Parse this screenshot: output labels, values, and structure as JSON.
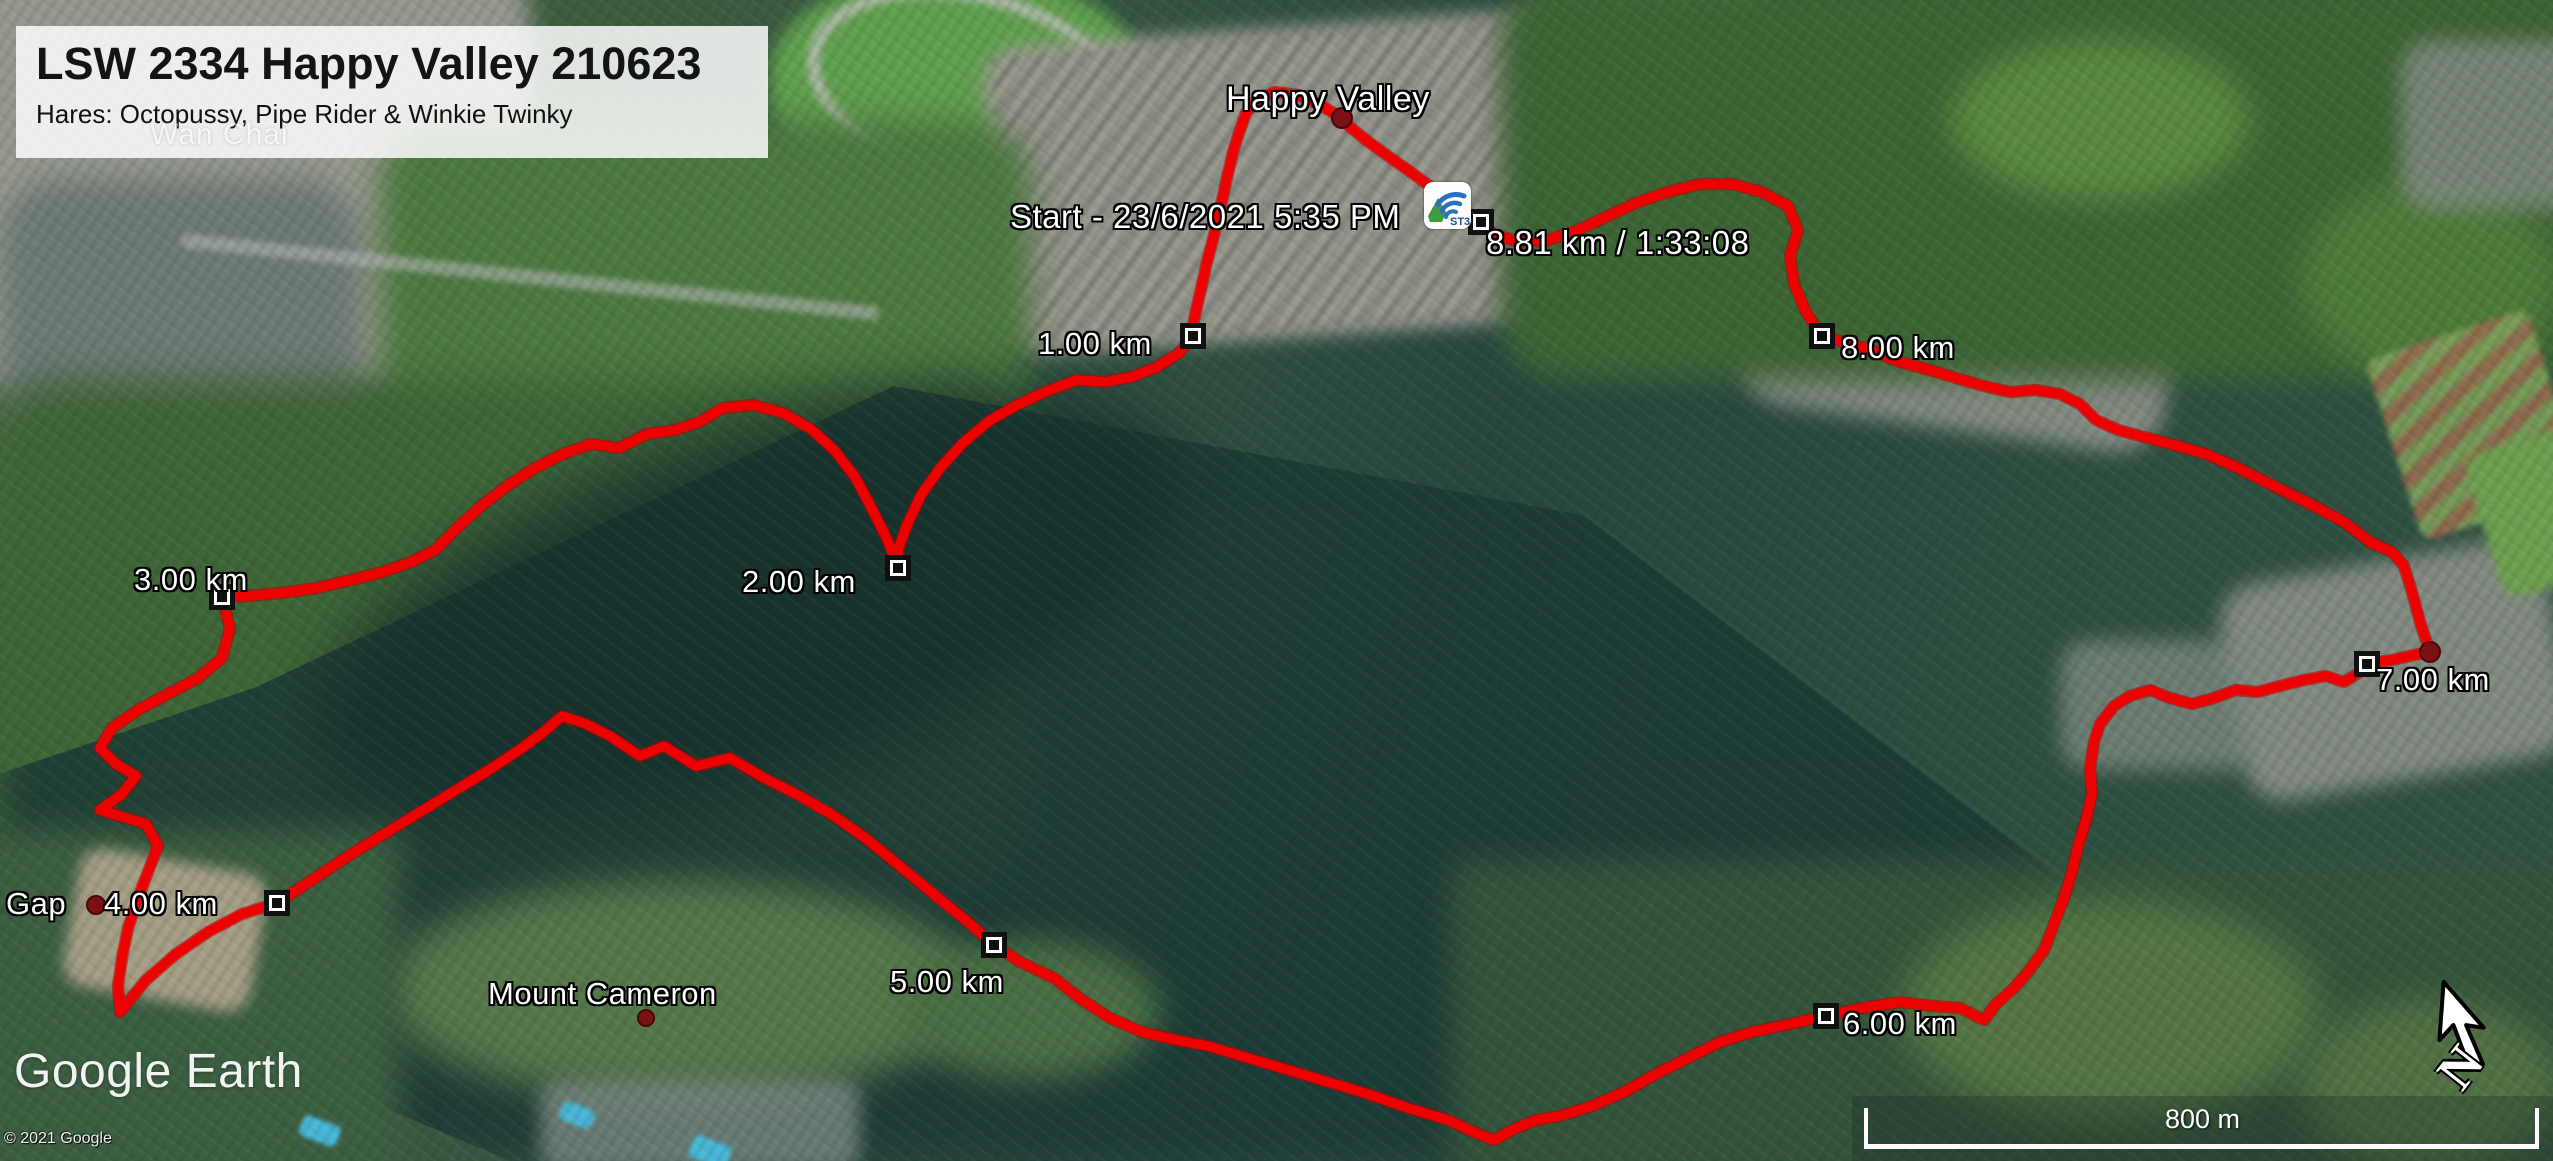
{
  "header": {
    "title": "LSW 2334 Happy Valley 210623",
    "subtitle": "Hares: Octopussy, Pipe Rider & Winkie Twinky"
  },
  "map_labels": {
    "background_place": "Wan Chai",
    "happy_valley": "Happy Valley",
    "start": "Start - 23/6/2021 5:35 PM",
    "gap": "Gap",
    "mount_cameron": "Mount Cameron"
  },
  "route": {
    "color": "#ee0201",
    "outline_color": "#b50000",
    "total_distance_km": "8.81 km",
    "total_time": "1:33:08",
    "km_markers": [
      {
        "label": "1.00 km",
        "x": 1193,
        "y": 336
      },
      {
        "label": "2.00 km",
        "x": 898,
        "y": 568
      },
      {
        "label": "3.00 km",
        "x": 222,
        "y": 597
      },
      {
        "label": "4.00 km",
        "x": 277,
        "y": 903
      },
      {
        "label": "5.00 km",
        "x": 994,
        "y": 945
      },
      {
        "label": "6.00 km",
        "x": 1826,
        "y": 1016
      },
      {
        "label": "7.00 km",
        "x": 2367,
        "y": 664
      },
      {
        "label": "8.00 km",
        "x": 1822,
        "y": 336
      },
      {
        "label": "8.81 km / 1:33:08",
        "x": 1481,
        "y": 222
      }
    ],
    "place_dots": [
      {
        "name": "happy-valley-dot",
        "x": 1342,
        "y": 118,
        "r": 9
      },
      {
        "name": "gap-dot",
        "x": 96,
        "y": 905,
        "r": 8
      },
      {
        "name": "mount-cameron-dot",
        "x": 646,
        "y": 1018,
        "r": 7
      },
      {
        "name": "route-end-dot",
        "x": 2430,
        "y": 652,
        "r": 9
      }
    ],
    "points": [
      [
        1447,
        200
      ],
      [
        1427,
        184
      ],
      [
        1405,
        168
      ],
      [
        1385,
        154
      ],
      [
        1366,
        140
      ],
      [
        1350,
        127
      ],
      [
        1342,
        118
      ],
      [
        1320,
        105
      ],
      [
        1298,
        95
      ],
      [
        1275,
        92
      ],
      [
        1257,
        100
      ],
      [
        1246,
        113
      ],
      [
        1240,
        130
      ],
      [
        1233,
        152
      ],
      [
        1227,
        178
      ],
      [
        1221,
        205
      ],
      [
        1214,
        235
      ],
      [
        1206,
        266
      ],
      [
        1199,
        298
      ],
      [
        1193,
        324
      ],
      [
        1193,
        336
      ],
      [
        1179,
        353
      ],
      [
        1157,
        367
      ],
      [
        1131,
        377
      ],
      [
        1105,
        382
      ],
      [
        1077,
        380
      ],
      [
        1047,
        391
      ],
      [
        1017,
        405
      ],
      [
        989,
        421
      ],
      [
        963,
        443
      ],
      [
        941,
        467
      ],
      [
        921,
        495
      ],
      [
        907,
        525
      ],
      [
        898,
        550
      ],
      [
        898,
        568
      ],
      [
        887,
        539
      ],
      [
        871,
        507
      ],
      [
        855,
        477
      ],
      [
        835,
        451
      ],
      [
        811,
        429
      ],
      [
        783,
        413
      ],
      [
        753,
        405
      ],
      [
        723,
        408
      ],
      [
        699,
        422
      ],
      [
        675,
        430
      ],
      [
        647,
        434
      ],
      [
        619,
        448
      ],
      [
        591,
        444
      ],
      [
        563,
        454
      ],
      [
        535,
        468
      ],
      [
        507,
        486
      ],
      [
        481,
        506
      ],
      [
        457,
        528
      ],
      [
        435,
        550
      ],
      [
        411,
        562
      ],
      [
        383,
        572
      ],
      [
        351,
        580
      ],
      [
        317,
        588
      ],
      [
        281,
        593
      ],
      [
        247,
        596
      ],
      [
        222,
        597
      ],
      [
        230,
        628
      ],
      [
        222,
        658
      ],
      [
        198,
        678
      ],
      [
        168,
        694
      ],
      [
        138,
        710
      ],
      [
        112,
        728
      ],
      [
        100,
        748
      ],
      [
        116,
        764
      ],
      [
        136,
        776
      ],
      [
        122,
        794
      ],
      [
        100,
        810
      ],
      [
        146,
        824
      ],
      [
        158,
        846
      ],
      [
        148,
        872
      ],
      [
        138,
        898
      ],
      [
        128,
        928
      ],
      [
        122,
        958
      ],
      [
        118,
        986
      ],
      [
        120,
        1012
      ],
      [
        146,
        980
      ],
      [
        176,
        954
      ],
      [
        208,
        932
      ],
      [
        242,
        914
      ],
      [
        277,
        903
      ],
      [
        312,
        880
      ],
      [
        348,
        856
      ],
      [
        384,
        834
      ],
      [
        420,
        812
      ],
      [
        456,
        790
      ],
      [
        492,
        768
      ],
      [
        522,
        748
      ],
      [
        546,
        730
      ],
      [
        562,
        716
      ],
      [
        586,
        724
      ],
      [
        610,
        736
      ],
      [
        640,
        756
      ],
      [
        664,
        746
      ],
      [
        696,
        766
      ],
      [
        730,
        758
      ],
      [
        764,
        778
      ],
      [
        800,
        796
      ],
      [
        834,
        816
      ],
      [
        868,
        840
      ],
      [
        902,
        868
      ],
      [
        936,
        896
      ],
      [
        968,
        922
      ],
      [
        994,
        945
      ],
      [
        1020,
        962
      ],
      [
        1054,
        978
      ],
      [
        1082,
        1000
      ],
      [
        1110,
        1018
      ],
      [
        1142,
        1032
      ],
      [
        1176,
        1040
      ],
      [
        1208,
        1046
      ],
      [
        1248,
        1058
      ],
      [
        1288,
        1070
      ],
      [
        1328,
        1082
      ],
      [
        1368,
        1094
      ],
      [
        1408,
        1108
      ],
      [
        1448,
        1120
      ],
      [
        1478,
        1134
      ],
      [
        1494,
        1140
      ],
      [
        1512,
        1130
      ],
      [
        1536,
        1120
      ],
      [
        1560,
        1116
      ],
      [
        1592,
        1106
      ],
      [
        1624,
        1092
      ],
      [
        1656,
        1074
      ],
      [
        1688,
        1058
      ],
      [
        1720,
        1042
      ],
      [
        1752,
        1032
      ],
      [
        1790,
        1024
      ],
      [
        1826,
        1016
      ],
      [
        1862,
        1008
      ],
      [
        1900,
        1002
      ],
      [
        1932,
        1006
      ],
      [
        1960,
        1008
      ],
      [
        1984,
        1020
      ],
      [
        1996,
        1004
      ],
      [
        2014,
        988
      ],
      [
        2028,
        972
      ],
      [
        2044,
        950
      ],
      [
        2054,
        924
      ],
      [
        2064,
        898
      ],
      [
        2072,
        872
      ],
      [
        2078,
        846
      ],
      [
        2086,
        820
      ],
      [
        2092,
        794
      ],
      [
        2090,
        768
      ],
      [
        2094,
        742
      ],
      [
        2100,
        724
      ],
      [
        2114,
        706
      ],
      [
        2130,
        696
      ],
      [
        2150,
        690
      ],
      [
        2170,
        698
      ],
      [
        2192,
        704
      ],
      [
        2214,
        698
      ],
      [
        2236,
        690
      ],
      [
        2258,
        692
      ],
      [
        2280,
        686
      ],
      [
        2304,
        680
      ],
      [
        2326,
        676
      ],
      [
        2344,
        682
      ],
      [
        2360,
        672
      ],
      [
        2367,
        664
      ],
      [
        2392,
        660
      ],
      [
        2414,
        655
      ],
      [
        2430,
        652
      ],
      [
        2420,
        622
      ],
      [
        2412,
        592
      ],
      [
        2404,
        566
      ],
      [
        2392,
        552
      ],
      [
        2370,
        542
      ],
      [
        2344,
        522
      ],
      [
        2318,
        508
      ],
      [
        2290,
        494
      ],
      [
        2262,
        480
      ],
      [
        2234,
        466
      ],
      [
        2206,
        454
      ],
      [
        2178,
        446
      ],
      [
        2148,
        438
      ],
      [
        2118,
        430
      ],
      [
        2096,
        420
      ],
      [
        2080,
        404
      ],
      [
        2060,
        394
      ],
      [
        2036,
        390
      ],
      [
        2010,
        392
      ],
      [
        1984,
        386
      ],
      [
        1956,
        378
      ],
      [
        1930,
        370
      ],
      [
        1900,
        362
      ],
      [
        1870,
        350
      ],
      [
        1844,
        342
      ],
      [
        1822,
        336
      ],
      [
        1806,
        312
      ],
      [
        1794,
        284
      ],
      [
        1790,
        256
      ],
      [
        1798,
        230
      ],
      [
        1788,
        206
      ],
      [
        1762,
        192
      ],
      [
        1732,
        184
      ],
      [
        1700,
        184
      ],
      [
        1668,
        192
      ],
      [
        1638,
        202
      ],
      [
        1608,
        216
      ],
      [
        1578,
        230
      ],
      [
        1548,
        240
      ],
      [
        1518,
        242
      ],
      [
        1494,
        234
      ],
      [
        1481,
        224
      ]
    ]
  },
  "start_icon": {
    "name": "tracker-app-icon",
    "text": "ST3"
  },
  "scale_bar": {
    "label": "800 m"
  },
  "compass": {
    "label": "N"
  },
  "attribution": {
    "logo": "Google Earth",
    "copyright": "© 2021 Google"
  }
}
